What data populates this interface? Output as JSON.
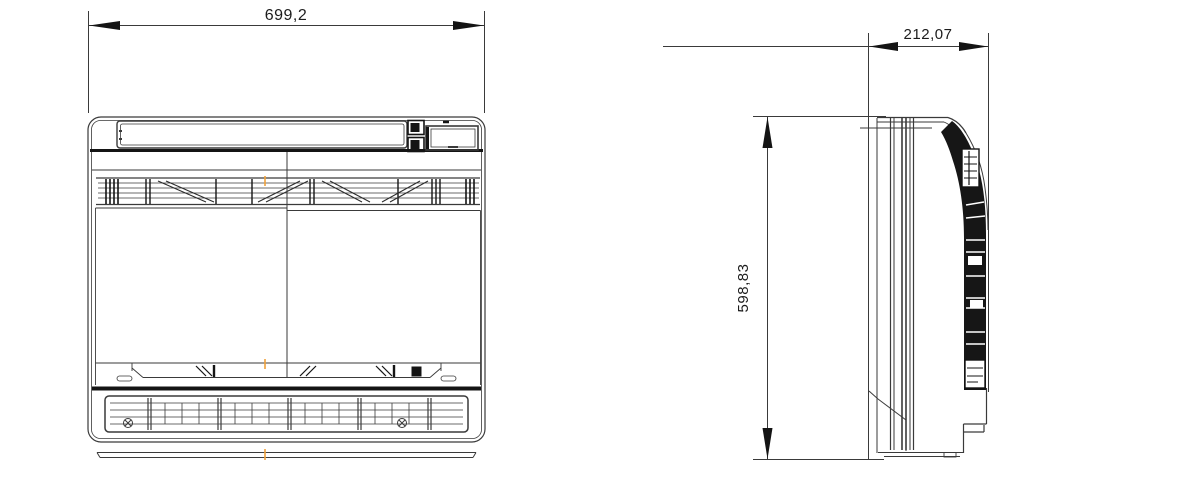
{
  "drawing": {
    "kind": "technical-dimension-drawing",
    "dims": {
      "width": "699,2",
      "depth": "212,07",
      "height": "598,83"
    },
    "colors": {
      "line": "#3a3a3a",
      "dark": "#141414",
      "centerline": "#f0a13a",
      "background": "#ffffff"
    },
    "icons": {
      "screw_left": "screw-icon",
      "screw_right": "screw-icon",
      "display_panel": "display-panel",
      "control_buttons": "control-button-icons"
    }
  }
}
